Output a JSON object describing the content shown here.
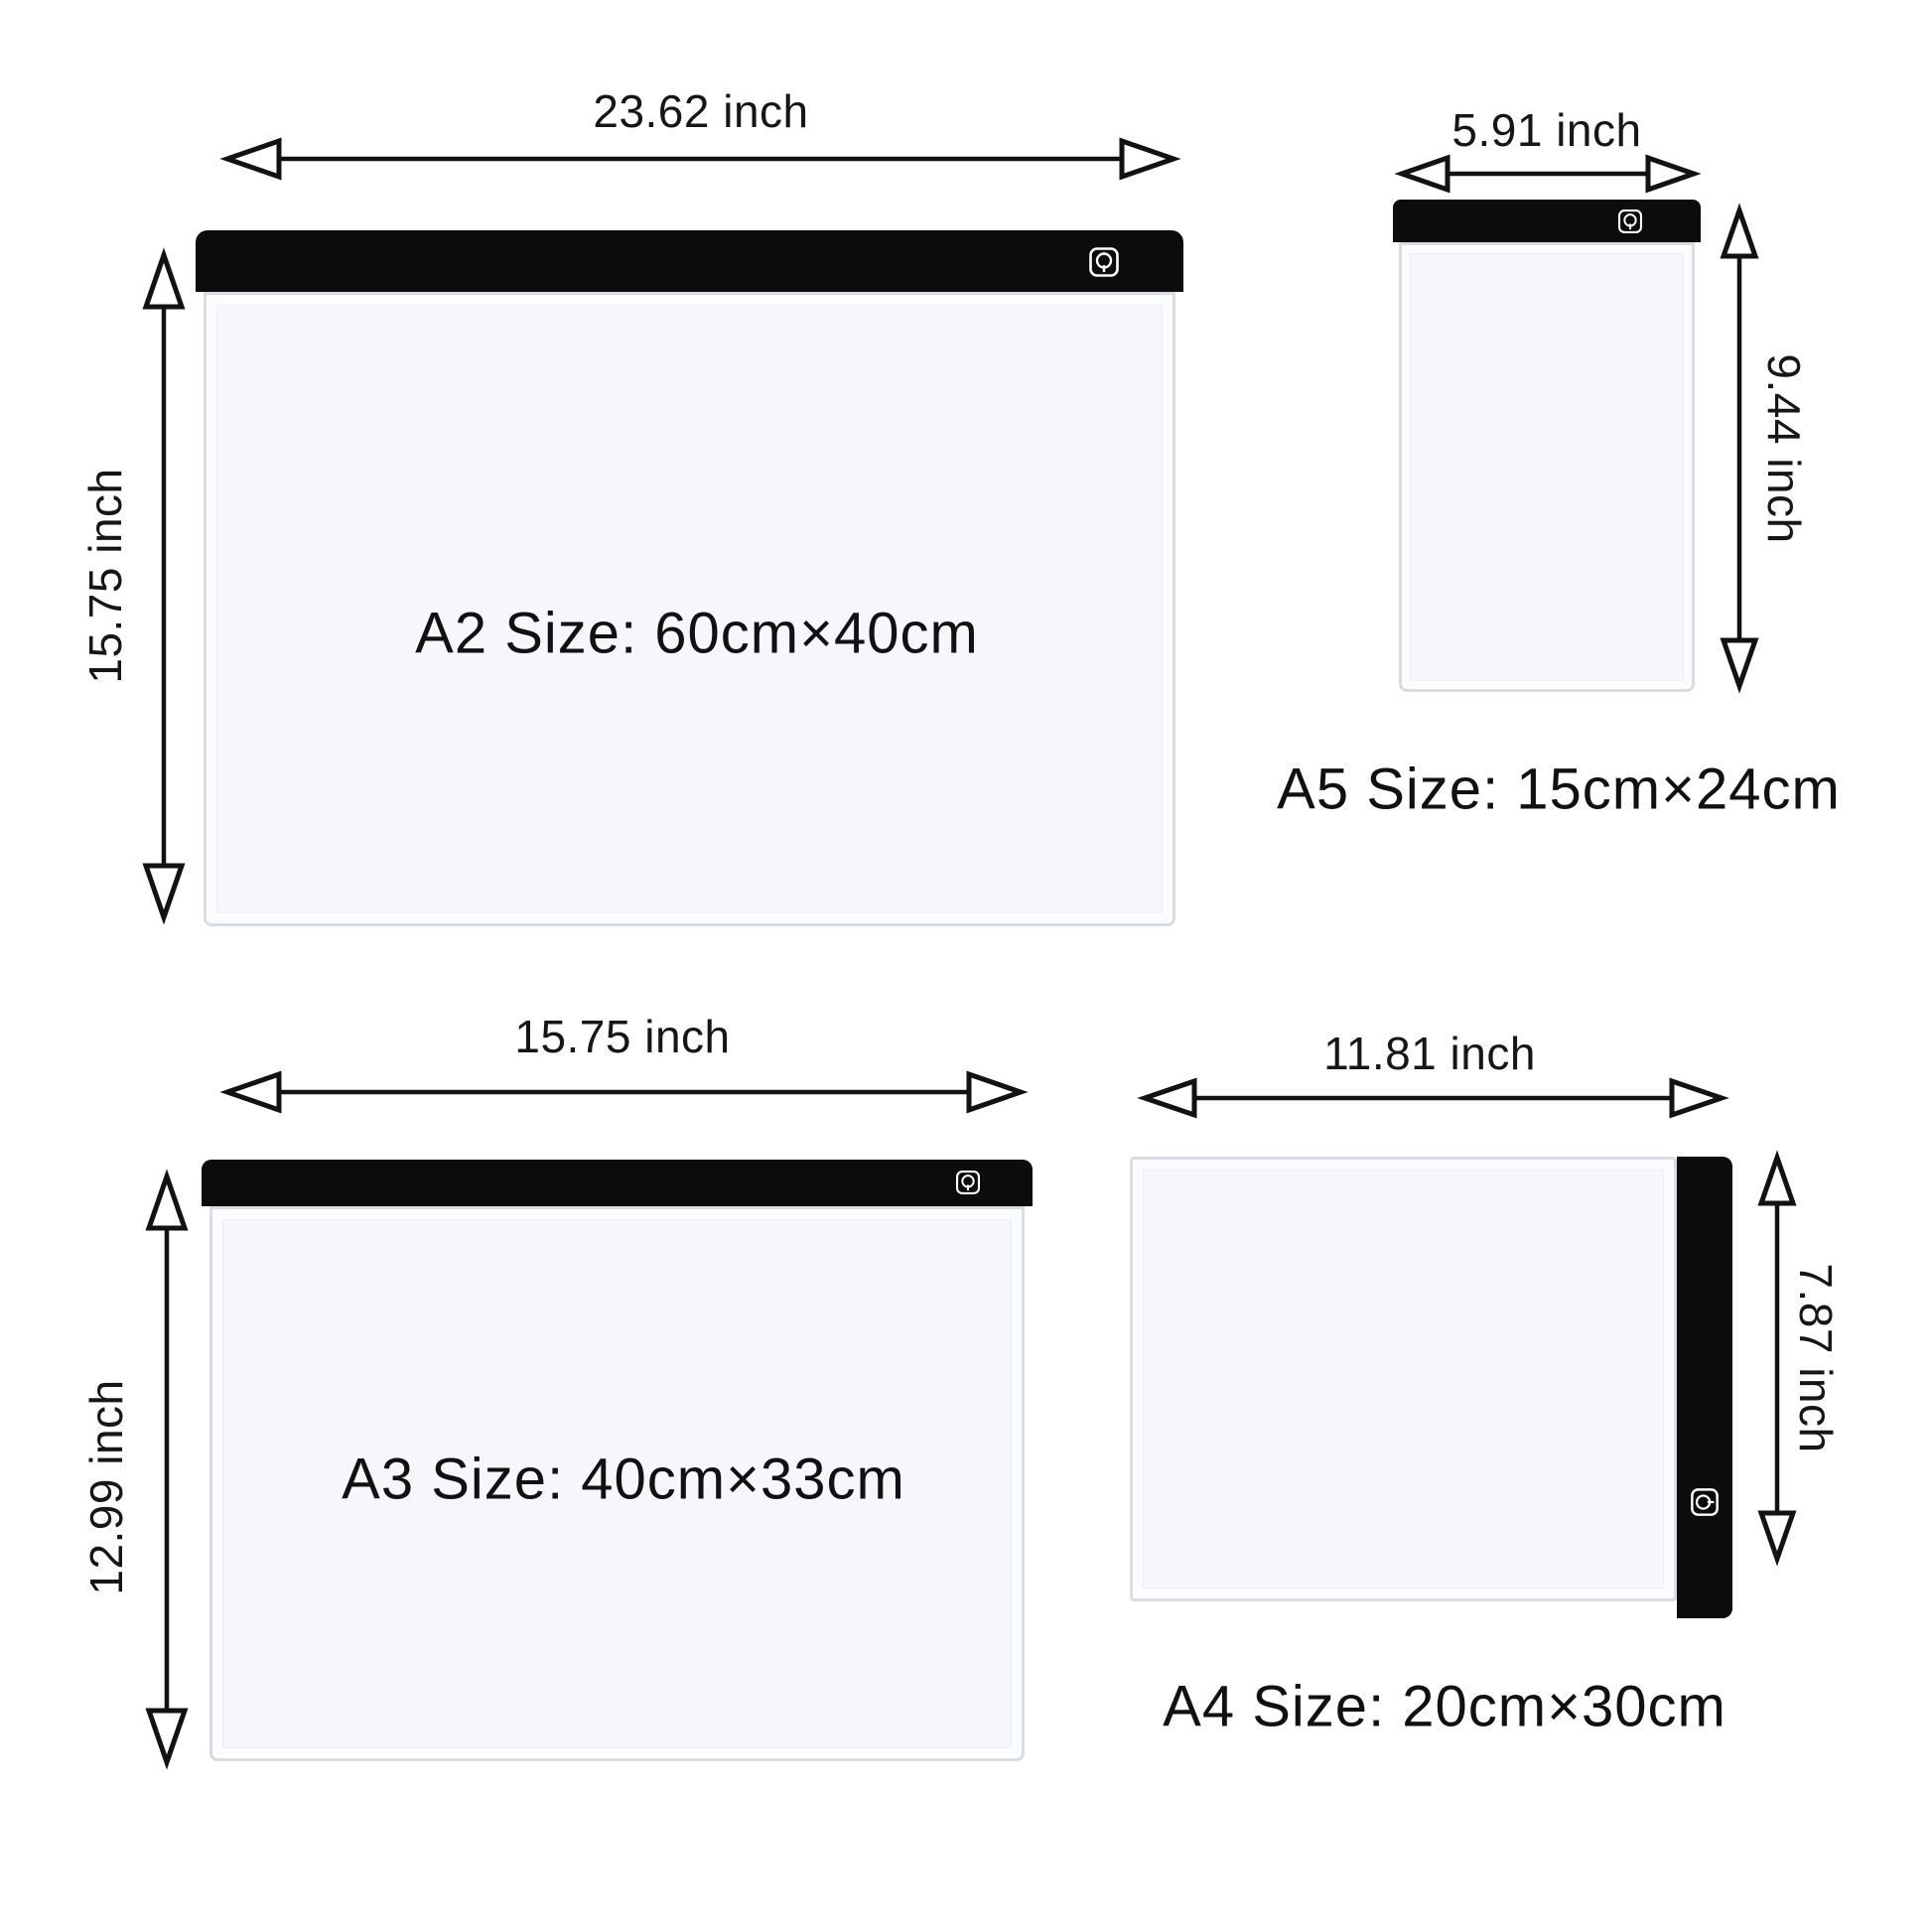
{
  "colors": {
    "background": "#ffffff",
    "bar_black": "#0c0c0c",
    "text": "#161616",
    "pad_frame_border": "#d9dde3",
    "pad_body": "#fbfcfe",
    "pad_surface": "#f5f7fb"
  },
  "icon_names": [
    "power-icon"
  ],
  "pads": [
    {
      "id": "a2",
      "size_label": "A2 Size:  60cm×40cm",
      "width_label": "23.62 inch",
      "height_label": "15.75 inch"
    },
    {
      "id": "a5",
      "size_label": "A5 Size:  15cm×24cm",
      "width_label": "5.91 inch",
      "height_label": "9.44 inch"
    },
    {
      "id": "a3",
      "size_label": "A3 Size:  40cm×33cm",
      "width_label": "15.75 inch",
      "height_label": "12.99 inch"
    },
    {
      "id": "a4",
      "size_label": "A4 Size:  20cm×30cm",
      "width_label": "11.81 inch",
      "height_label": "7.87 inch"
    }
  ]
}
